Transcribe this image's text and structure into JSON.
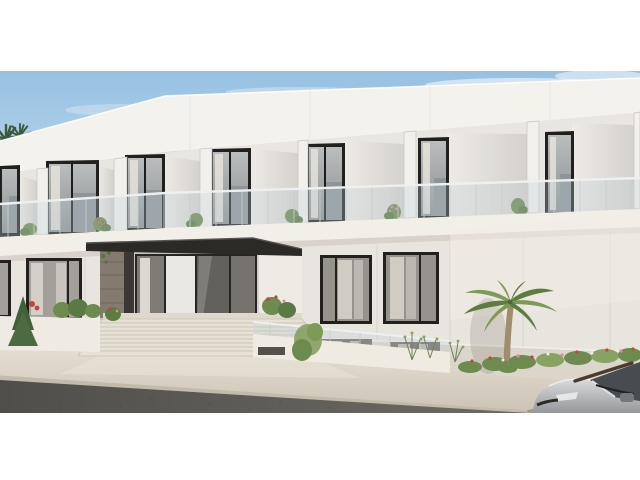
{
  "scene": {
    "type": "architectural-exterior-rendering",
    "subject": "Modern two-storey white apartment building",
    "time_of_day": "daytime",
    "elements": {
      "upper_floor": "seven recessed balconies with glass railings, dark framed sliding doors and potted plants",
      "ground_floor": "entrance with dark canopy, glass doors, stone accent wall and wide staircase",
      "right_wing": "blank light wall with palm tree and flower bed",
      "street": "asphalt road and light stone sidewalk",
      "vehicle": "silver car parked at lower right"
    },
    "counts": {
      "balcony_bays": 7,
      "stair_steps": 9,
      "ground_windows": 4
    }
  },
  "palette": {
    "letterbox": "#ffffff",
    "sky_top": "#96c0e2",
    "sky_bottom": "#d9edf6",
    "cloud": "#ffffff",
    "wall": "#e8e4de",
    "fascia": "#f4f2ed",
    "soffit": "#d7d3cd",
    "bay_back": "#e9e6e1",
    "facet_light": "#edeae5",
    "facet_dark": "#d6d3ce",
    "column": "#f2f0ec",
    "frame_dark": "#21201e",
    "door_glass": "#a9adae",
    "privacy_panel": "#8f9499",
    "curtain": "#e6e2db",
    "handrail": "#edeff0",
    "railing_post": "#c7ccce",
    "railing_glass": "#bfd0d8",
    "slab": "#f2efe9",
    "entrance_recess": "#c8c3bc",
    "stone": "#847b70",
    "fin_dark": "#3a3734",
    "canopy": "#2c2a27",
    "glass_dark": "#63615c",
    "interior_light": "#e9e7e3",
    "base_zone": "#dbd5cc",
    "lower_window": "#6f6963",
    "lower_curtain": "#c9c2b7",
    "stair_tread": "#e6e0d5",
    "stair_riser": "#c9c1b3",
    "planter_wall": "#efebe3",
    "sidewalk": "#dcd5c9",
    "curb": "#c3bbaa",
    "road": "#565450",
    "bush_dark": "#42603c",
    "bush_mid": "#6d8a4f",
    "bush_light": "#8aa268",
    "flower_red": "#c4453f",
    "flower_pink": "#d98ca0",
    "flower_white": "#efefe8",
    "palm_frond": "#7c9b56",
    "palm_frond_dark": "#5d7c40",
    "palm_trunk": "#a08c6e",
    "distant_palm": "#2e4a33",
    "car_glass": "#474c51",
    "car_detail": "#23221f",
    "car_mirror": "#75787b"
  }
}
